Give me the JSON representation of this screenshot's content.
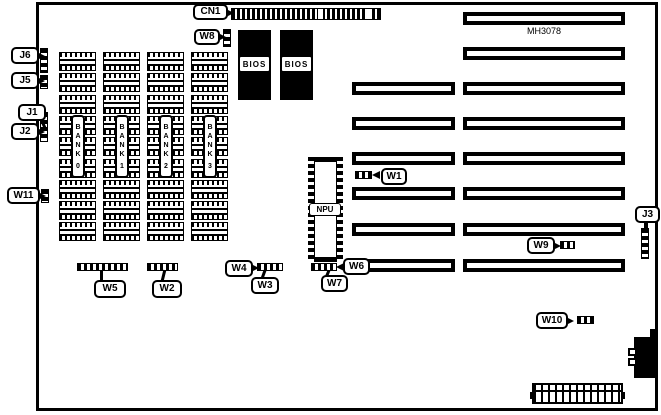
{
  "board": {
    "model": "MH3078"
  },
  "callouts": {
    "cn1": "CN1",
    "w8": "W8",
    "j6": "J6",
    "j5": "J5",
    "j1": "J1",
    "j2": "J2",
    "w11": "W11",
    "w1": "W1",
    "j3": "J3",
    "w9": "W9",
    "w10": "W10",
    "w6": "W6",
    "w7": "W7",
    "w5": "W5",
    "w2": "W2",
    "w4": "W4",
    "w3": "W3"
  },
  "chips": {
    "npu": "NPU",
    "bios": [
      "BIOS",
      "BIOS"
    ]
  },
  "memory": {
    "bank_labels": [
      "BANK 0",
      "BANK 1",
      "BANK 2",
      "BANK 3"
    ],
    "chips_per_bank": 9
  },
  "slots": {
    "count": 8,
    "extended_rows": [
      3,
      4,
      5,
      6,
      7,
      8
    ]
  },
  "colors": {
    "ink": "#000000",
    "paper": "#ffffff"
  }
}
